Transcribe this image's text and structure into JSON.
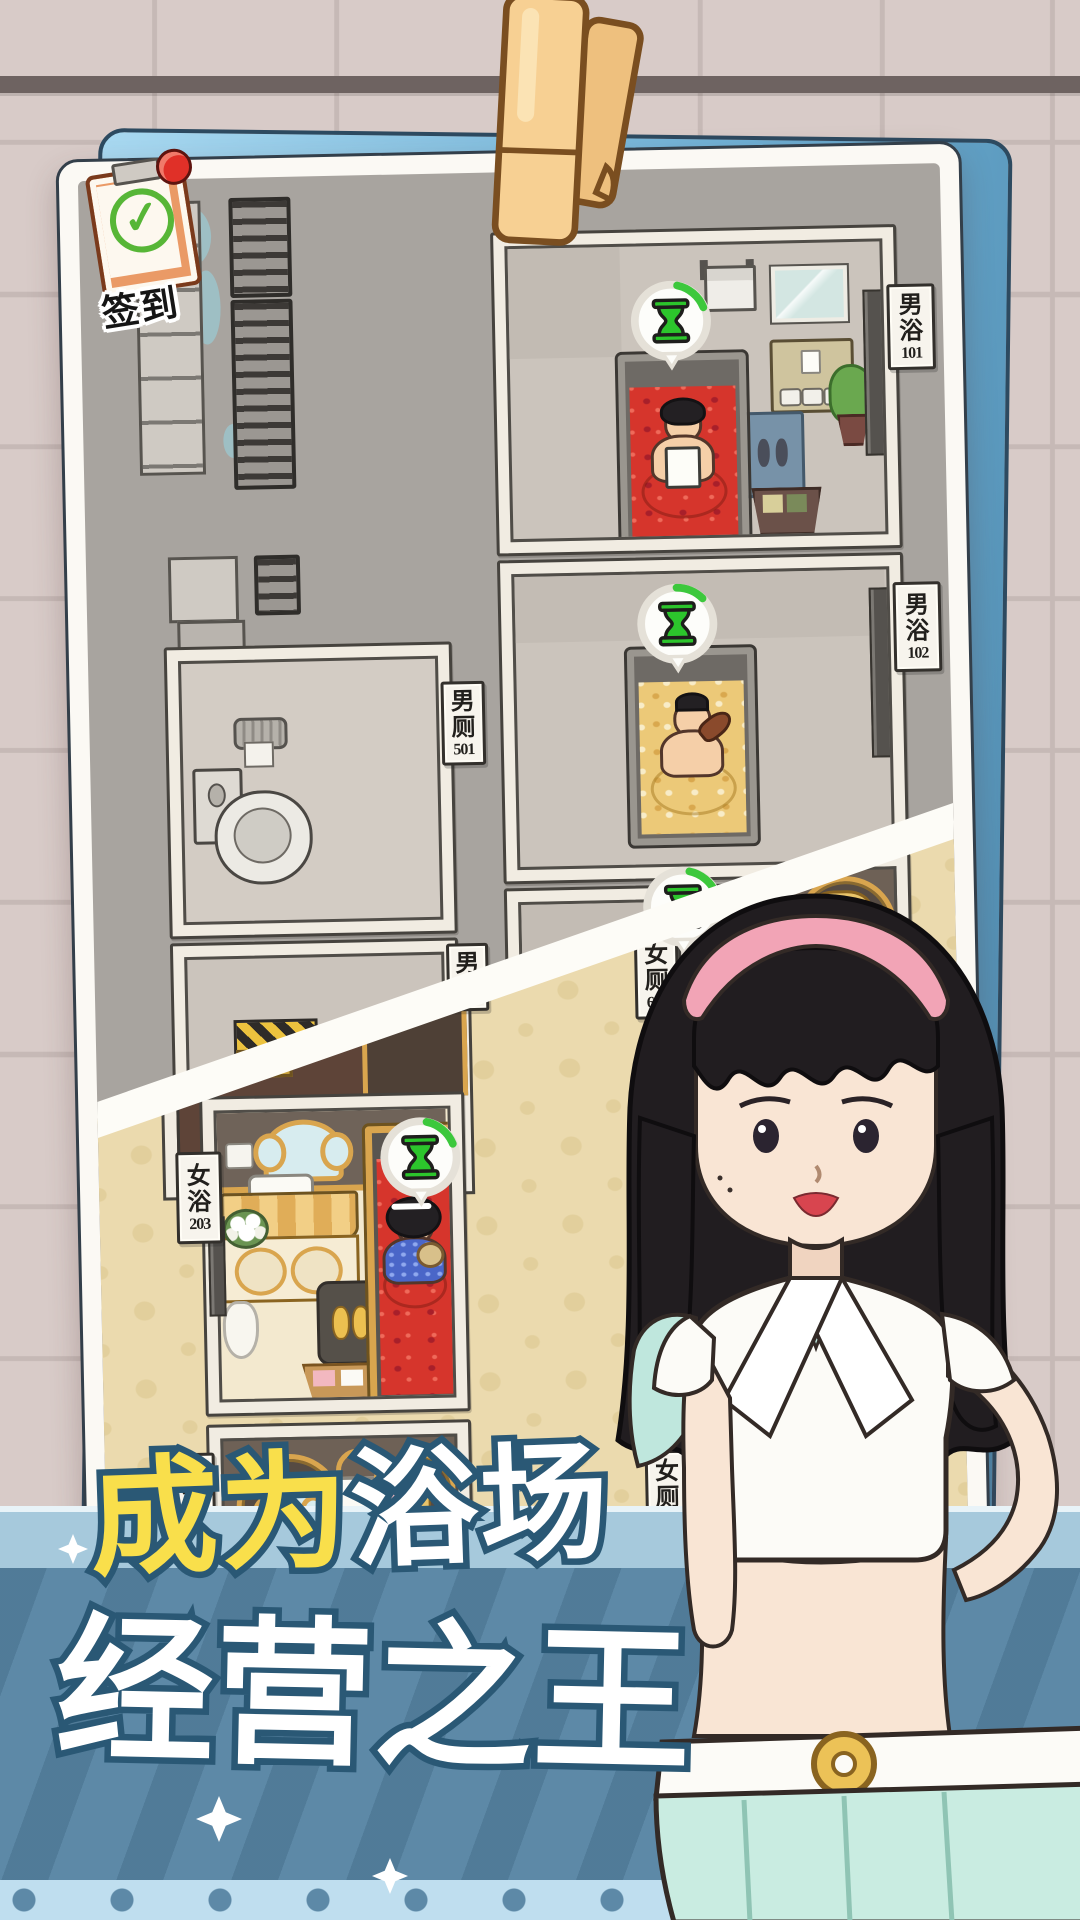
{
  "checkin": {
    "label": "签到",
    "check_glyph": "✓"
  },
  "plaques": {
    "male_bath_101": {
      "line1": "男",
      "line2": "浴",
      "number": "101"
    },
    "male_bath_102": {
      "line1": "男",
      "line2": "浴",
      "number": "102"
    },
    "male_toilet_501": {
      "line1": "男",
      "line2": "厕",
      "number": "501"
    },
    "male_toilet_upper": {
      "line1": "男",
      "line2": "厕",
      "number": ""
    },
    "female_bath_203": {
      "line1": "女",
      "line2": "浴",
      "number": "203"
    },
    "female_bath_lower": {
      "line1": "女",
      "line2": "浴",
      "number": ""
    },
    "female_toilet_601": {
      "line1": "女",
      "line2": "厕",
      "number": "601"
    },
    "female_toilet_602": {
      "line1": "女",
      "line2": "厕",
      "number": "602"
    },
    "female_toilet_603": {
      "line1": "女",
      "line2": "厕",
      "number": "603"
    }
  },
  "banner": {
    "line1_yellow": "成为",
    "line1_white": "浴场",
    "line2": "经营之王"
  },
  "colors": {
    "banner_blue": "#5d89a7",
    "banner_light": "#a6c9dc",
    "title_outline": "#2a5875",
    "title_yellow": "#f9df4b",
    "timer_green": "#2cc52c",
    "bath_red": "#d6352c",
    "bath_yellow": "#ecc978",
    "gold": "#d9a54e",
    "photo_back_blue": "#6fb1d6"
  }
}
